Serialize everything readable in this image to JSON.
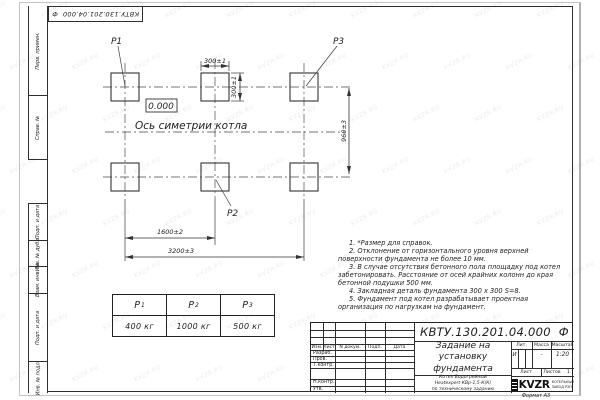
{
  "watermark": {
    "text": "KVZR.RU"
  },
  "stamp_top": "КВТУ.130.201.04.000  Ф",
  "side_strip": {
    "perv_primen": "Перв. примен.",
    "sprav_no": "Справ. №",
    "podp_data_1": "Подп. и дата",
    "inv_dubl": "Инв. № дубл.",
    "vzam_inv": "Взам. инв. №",
    "podp_data_2": "Подп. и дата",
    "inv_podl": "Инв. № подл."
  },
  "drawing": {
    "labels": {
      "p1": "P1",
      "p2": "P2",
      "p3": "P3"
    },
    "elevation": "0.000",
    "axis_label": "Ось симетрии котла",
    "dims": {
      "pad_width": "300±1",
      "pad_height": "300±1",
      "row_spacing": "960±3",
      "col_spacing": "1600±2",
      "total_width": "3200±3"
    }
  },
  "load_table": {
    "columns": [
      {
        "symbol": "P",
        "sub": "1",
        "value": "400 кг"
      },
      {
        "symbol": "P",
        "sub": "2",
        "value": "1000 кг"
      },
      {
        "symbol": "P",
        "sub": "3",
        "value": "500 кг"
      }
    ]
  },
  "notes": {
    "items": [
      "1. *Размер для справок.",
      "2. Отклонение от горизонтального уровня верхней поверхности фундамента не более 10 мм.",
      "3. В случае отсутствия бетонного пола площадку под котел забетонировать. Расстояние от осей крайних колонн до края бетонной подушки 500 мм.",
      "4. Закладная деталь фундамента  300 х 300 S=8.",
      "5. Фундамент под котел разрабатывает проектная организация по нагрузкам на фундамент."
    ]
  },
  "title_block": {
    "doc_number": "КВТУ.130.201.04.000  Ф",
    "title_lines": [
      "Задание на",
      "установку",
      "фундамента"
    ],
    "subtitle_lines": [
      "Котел Водогрейный",
      "Heatexpert-КВр-1,5-К(К)",
      "по техническому заданию"
    ],
    "headers": {
      "izm": "Изм.",
      "list": "Лист",
      "ndoc": "N докум.",
      "podp": "Подп.",
      "data": "Дата",
      "lit": "Лит.",
      "massa": "Масса",
      "masshtab": "Масштаб",
      "list2": "Лист",
      "listov": "Листов"
    },
    "rows": {
      "razrab": "Разраб.",
      "prov": "Пров.",
      "tkontr": "Т.контр.",
      "nkontr": "Н.контр.",
      "utv": "Утв."
    },
    "values": {
      "lit": "И",
      "massa": "-",
      "masshtab": "1:20",
      "listov_num": "1"
    },
    "logo": {
      "name": "KVZR",
      "caption_lines": [
        "КОТЕЛЬНЫЙ",
        "ЗАВОД РЭП"
      ]
    },
    "format": "Формат А3"
  }
}
